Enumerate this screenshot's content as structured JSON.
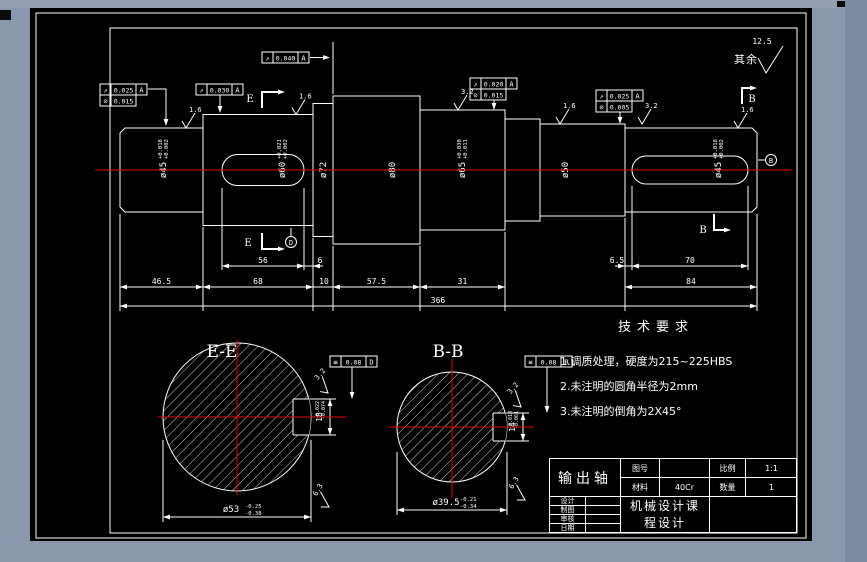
{
  "window": {
    "buttons": [
      "minimize",
      "close"
    ]
  },
  "corner_note": {
    "label": "其余",
    "roughness": "12.5"
  },
  "tech_req": {
    "title": "技术要求",
    "items": [
      "1.调质处理，硬度为215~225HBS",
      "2.未注明的圆角半径为2mm",
      "3.未注明的倒角为2X45°"
    ]
  },
  "title_block": {
    "part_name": "输出轴",
    "drawing_no_label": "图号",
    "drawing_no": "",
    "scale_label": "比例",
    "scale": "1:1",
    "material_label": "材料",
    "material": "40Cr",
    "qty_label": "数量",
    "qty": "1",
    "sign_rows": [
      {
        "label": "设计",
        "value": ""
      },
      {
        "label": "制图",
        "value": ""
      },
      {
        "label": "审核",
        "value": ""
      },
      {
        "label": "日期",
        "value": ""
      }
    ],
    "course_line1": "机械设计课",
    "course_line2": "程设计"
  },
  "main_view": {
    "centerline_color": "#e60000",
    "diameter_labels": [
      {
        "text": "ø45",
        "sup": "+0.018",
        "sub": "+0.002"
      },
      {
        "text": "ø60",
        "sup": "+0.021",
        "sub": "+0.002"
      },
      {
        "text": "ø72",
        "sup": "",
        "sub": ""
      },
      {
        "text": "ø80",
        "sup": "",
        "sub": ""
      },
      {
        "text": "ø65",
        "sup": "+0.030",
        "sub": "+0.011"
      },
      {
        "text": "ø50",
        "sup": "",
        "sub": ""
      },
      {
        "text": "ø45",
        "sup": "+0.018",
        "sub": "+0.002"
      }
    ],
    "dims_keyway": [
      "56",
      "6",
      "6.5",
      "70"
    ],
    "dims_chain": [
      "46.5",
      "68",
      "10",
      "57.5",
      "31",
      "84"
    ],
    "dim_total": "366",
    "tol_frames": [
      {
        "rows": [
          {
            "sym": "runout",
            "val": "0.025",
            "datum": "A"
          },
          {
            "sym": "cylindricity",
            "val": "0.015",
            "datum": ""
          }
        ]
      },
      {
        "rows": [
          {
            "sym": "runout",
            "val": "0.030",
            "datum": "A"
          }
        ]
      },
      {
        "rows": [
          {
            "sym": "runout",
            "val": "0.040",
            "datum": "A"
          }
        ]
      },
      {
        "rows": [
          {
            "sym": "runout",
            "val": "0.020",
            "datum": "A"
          },
          {
            "sym": "cylindricity",
            "val": "0.015",
            "datum": ""
          }
        ]
      },
      {
        "rows": [
          {
            "sym": "runout",
            "val": "0.025",
            "datum": "A"
          },
          {
            "sym": "cylindricity",
            "val": "0.005",
            "datum": ""
          }
        ]
      }
    ],
    "roughness": [
      "1.6",
      "1.6",
      "3.2",
      "1.6",
      "3.2",
      "1.6"
    ],
    "section_letter_e": "E",
    "section_letter_b": "B",
    "datum_d": "D",
    "datum_b": "B"
  },
  "sections": [
    {
      "title": "E-E",
      "diameter": "ø53",
      "tol_up": "-0.25",
      "tol_dn": "-0.38",
      "key_width": "18",
      "kw_up": "-0.022",
      "kw_dn": "-0.074",
      "roughness_side": "3.2",
      "roughness_bottom": "6.3",
      "frame": {
        "sym": "symmetry",
        "val": "0.08",
        "datum": "D"
      }
    },
    {
      "title": "B-B",
      "diameter": "ø39.5",
      "tol_up": "-0.21",
      "tol_dn": "-0.34",
      "key_width": "14",
      "kw_up": "-0.018",
      "kw_dn": "-0.061",
      "roughness_side": "3.2",
      "roughness_bottom": "6.3",
      "frame": {
        "sym": "symmetry",
        "val": "0.08",
        "datum": "B"
      }
    }
  ]
}
